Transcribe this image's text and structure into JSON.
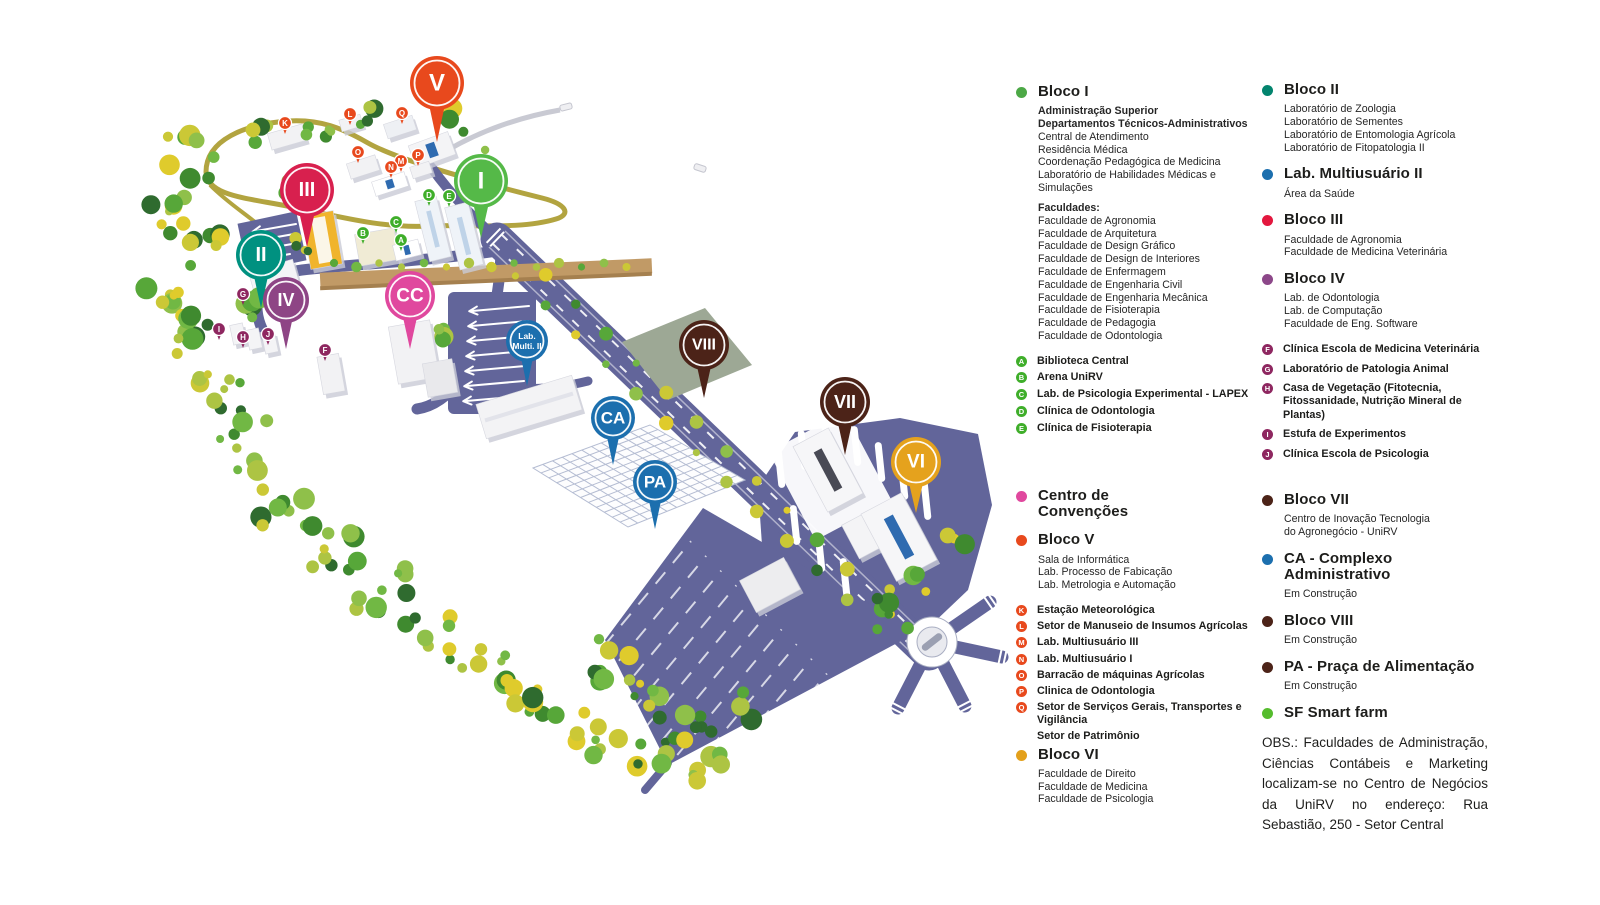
{
  "map": {
    "pins": [
      {
        "id": "V",
        "label": "V",
        "x": 437,
        "y": 83,
        "r": 27,
        "tail": 32,
        "fs": 24,
        "c": "#E8491D"
      },
      {
        "id": "I",
        "label": "I",
        "x": 481,
        "y": 181,
        "r": 27,
        "tail": 30,
        "fs": 24,
        "c": "#55B948"
      },
      {
        "id": "III",
        "label": "III",
        "x": 307,
        "y": 190,
        "r": 27,
        "tail": 30,
        "fs": 20,
        "c": "#D8204E"
      },
      {
        "id": "II",
        "label": "II",
        "x": 261,
        "y": 255,
        "r": 25,
        "tail": 28,
        "fs": 20,
        "c": "#009180"
      },
      {
        "id": "IV",
        "label": "IV",
        "x": 286,
        "y": 300,
        "r": 23,
        "tail": 26,
        "fs": 18,
        "c": "#8E4585"
      },
      {
        "id": "CC",
        "label": "CC",
        "x": 410,
        "y": 296,
        "r": 25,
        "tail": 28,
        "fs": 19,
        "c": "#E0489E"
      },
      {
        "id": "LM2",
        "label": "Lab.\nMulti. II",
        "x": 527,
        "y": 341,
        "r": 21,
        "tail": 24,
        "fs": 8.5,
        "c": "#1C6FAE"
      },
      {
        "id": "VIII",
        "label": "VIII",
        "x": 704,
        "y": 345,
        "r": 25,
        "tail": 28,
        "fs": 16,
        "c": "#4C2318"
      },
      {
        "id": "CA",
        "label": "CA",
        "x": 613,
        "y": 418,
        "r": 22,
        "tail": 25,
        "fs": 17,
        "c": "#1C6FAE"
      },
      {
        "id": "VII",
        "label": "VII",
        "x": 845,
        "y": 402,
        "r": 25,
        "tail": 28,
        "fs": 18,
        "c": "#4C2318"
      },
      {
        "id": "PA",
        "label": "PA",
        "x": 655,
        "y": 482,
        "r": 22,
        "tail": 25,
        "fs": 17,
        "c": "#1C6FAE"
      },
      {
        "id": "VI",
        "label": "VI",
        "x": 916,
        "y": 462,
        "r": 25,
        "tail": 26,
        "fs": 19,
        "c": "#E5A21D"
      }
    ],
    "badges": [
      {
        "k": "A",
        "x": 401,
        "y": 240,
        "c": "#3FAE2A"
      },
      {
        "k": "B",
        "x": 363,
        "y": 233,
        "c": "#3FAE2A"
      },
      {
        "k": "C",
        "x": 396,
        "y": 222,
        "c": "#3FAE2A"
      },
      {
        "k": "D",
        "x": 429,
        "y": 195,
        "c": "#3FAE2A"
      },
      {
        "k": "E",
        "x": 449,
        "y": 196,
        "c": "#3FAE2A"
      },
      {
        "k": "F",
        "x": 325,
        "y": 350,
        "c": "#8E2760"
      },
      {
        "k": "G",
        "x": 243,
        "y": 294,
        "c": "#8E2760"
      },
      {
        "k": "H",
        "x": 243,
        "y": 337,
        "c": "#8E2760"
      },
      {
        "k": "I",
        "x": 219,
        "y": 329,
        "c": "#8E2760"
      },
      {
        "k": "J",
        "x": 268,
        "y": 334,
        "c": "#8E2760"
      },
      {
        "k": "K",
        "x": 285,
        "y": 123,
        "c": "#E8491D"
      },
      {
        "k": "L",
        "x": 350,
        "y": 114,
        "c": "#E8491D"
      },
      {
        "k": "M",
        "x": 401,
        "y": 161,
        "c": "#E8491D"
      },
      {
        "k": "N",
        "x": 391,
        "y": 167,
        "c": "#E8491D"
      },
      {
        "k": "O",
        "x": 358,
        "y": 152,
        "c": "#E8491D"
      },
      {
        "k": "P",
        "x": 418,
        "y": 155,
        "c": "#E8491D"
      },
      {
        "k": "Q",
        "x": 402,
        "y": 113,
        "c": "#E8491D"
      }
    ]
  },
  "legend": {
    "left_top": {
      "section": {
        "title": "Bloco I",
        "color": "#4CA846",
        "lines": [
          {
            "text": "Administração Superior",
            "bold": 1
          },
          {
            "text": "Departamentos Técnicos-Administrativos",
            "bold": 1
          },
          {
            "text": "Central de Atendimento"
          },
          {
            "text": "Residência Médica"
          },
          {
            "text": "Coordenação Pedagógica de Medicina"
          },
          {
            "text": "Laboratório de Habilidades Médicas e Simulações"
          },
          {
            "text": "Faculdades:",
            "bold": 1,
            "gap": 1
          },
          {
            "text": "Faculdade de Agronomia"
          },
          {
            "text": "Faculdade de Arquitetura"
          },
          {
            "text": "Faculdade de Design Gráfico"
          },
          {
            "text": "Faculdade de Design de Interiores"
          },
          {
            "text": "Faculdade de Enfermagem"
          },
          {
            "text": "Faculdade de Engenharia Civil"
          },
          {
            "text": "Faculdade de Engenharia Mecânica"
          },
          {
            "text": "Faculdade de Fisioterapia"
          },
          {
            "text": "Faculdade de Pedagogia"
          },
          {
            "text": "Faculdade de Odontologia"
          }
        ]
      },
      "letters": {
        "color": "#3FAE2A",
        "entries": [
          {
            "k": "A",
            "t": "Biblioteca Central"
          },
          {
            "k": "B",
            "t": "Arena UniRV"
          },
          {
            "k": "C",
            "t": "Lab. de Psicologia Experimental - LAPEX"
          },
          {
            "k": "D",
            "t": "Clínica de Odontologia"
          },
          {
            "k": "E",
            "t": "Clínica de Fisioterapia"
          }
        ]
      }
    },
    "right_top": {
      "sections": [
        {
          "title": "Bloco II",
          "color": "#03846E",
          "lines": [
            "Laboratório de Zoologia",
            "Laboratório de Sementes",
            "Laboratório de Entomologia Agrícola",
            "Laboratório de Fitopatologia II"
          ]
        },
        {
          "title": "Lab. Multiusuário II",
          "color": "#1C6FAE",
          "lines": [
            "Área da Saúde"
          ]
        },
        {
          "title": "Bloco III",
          "color": "#E3173E",
          "lines": [
            "Faculdade de Agronomia",
            "Faculdade de Medicina Veterinária"
          ]
        },
        {
          "title": "Bloco IV",
          "color": "#8C4789",
          "lines": [
            "Lab. de Odontologia",
            "Lab. de Computação",
            "Faculdade de Eng. Software"
          ]
        }
      ],
      "letters": {
        "color": "#8E2760",
        "entries": [
          {
            "k": "F",
            "t": "Clínica Escola de Medicina Veterinária"
          },
          {
            "k": "G",
            "t": "Laboratório de Patologia Animal"
          },
          {
            "k": "H",
            "t": "Casa de Vegetação (Fitotecnia, Fitossanidade, Nutrição Mineral de Plantas)"
          },
          {
            "k": "I",
            "t": "Estufa de Experimentos"
          },
          {
            "k": "J",
            "t": "Clínica Escola de Psicologia"
          }
        ]
      }
    },
    "left_bottom": {
      "sections_before": [
        {
          "title": "Centro de\nConvenções",
          "color": "#E0489E",
          "lines": []
        },
        {
          "title": "Bloco V",
          "color": "#E8491D",
          "lines": [
            "Sala de Informática",
            "Lab. Processo de Fabicação",
            "Lab. Metrologia e Automação"
          ]
        }
      ],
      "letters": {
        "color": "#E8491D",
        "entries": [
          {
            "k": "K",
            "t": "Estação Meteorológica"
          },
          {
            "k": "L",
            "t": "Setor de Manuseio de Insumos Agrícolas"
          },
          {
            "k": "M",
            "t": "Lab. Multiusuário III"
          },
          {
            "k": "N",
            "t": "Lab. Multiusuário I"
          },
          {
            "k": "O",
            "t": "Barracão de máquinas Agrícolas"
          },
          {
            "k": "P",
            "t": "Clinica de Odontologia"
          },
          {
            "k": "Q",
            "t": "Setor de Serviços Gerais, Transportes e Vigilância"
          },
          {
            "k": "",
            "t": "Setor de Patrimônio"
          }
        ]
      },
      "sections_after": [
        {
          "title": "Bloco VI",
          "color": "#E3A01B",
          "lines": [
            "Faculdade de Direito",
            "Faculdade de Medicina",
            "Faculdade de Psicologia"
          ]
        }
      ]
    },
    "right_bottom": {
      "sections": [
        {
          "title": "Bloco VII",
          "color": "#4C2318",
          "lines": [
            "Centro de Inovação Tecnologia",
            "do Agronegócio - UniRV"
          ]
        },
        {
          "title": "CA - Complexo\nAdministrativo",
          "color": "#1C6FAE",
          "lines": [
            "Em Construção"
          ]
        },
        {
          "title": "Bloco VIII",
          "color": "#4C2318",
          "lines": [
            "Em Construção"
          ]
        },
        {
          "title": "PA - Praça de Alimentação",
          "color": "#4C2318",
          "lines": [
            "Em Construção"
          ]
        },
        {
          "title": "SF Smart farm",
          "color": "#55BC2D",
          "lines": []
        }
      ],
      "obs": "OBS.: Faculdades de Administração, Ciências Contábeis e Marketing localizam-se no Centro de Negócios da UniRV no endereço: Rua Sebastião, 250 - Setor Central"
    }
  }
}
